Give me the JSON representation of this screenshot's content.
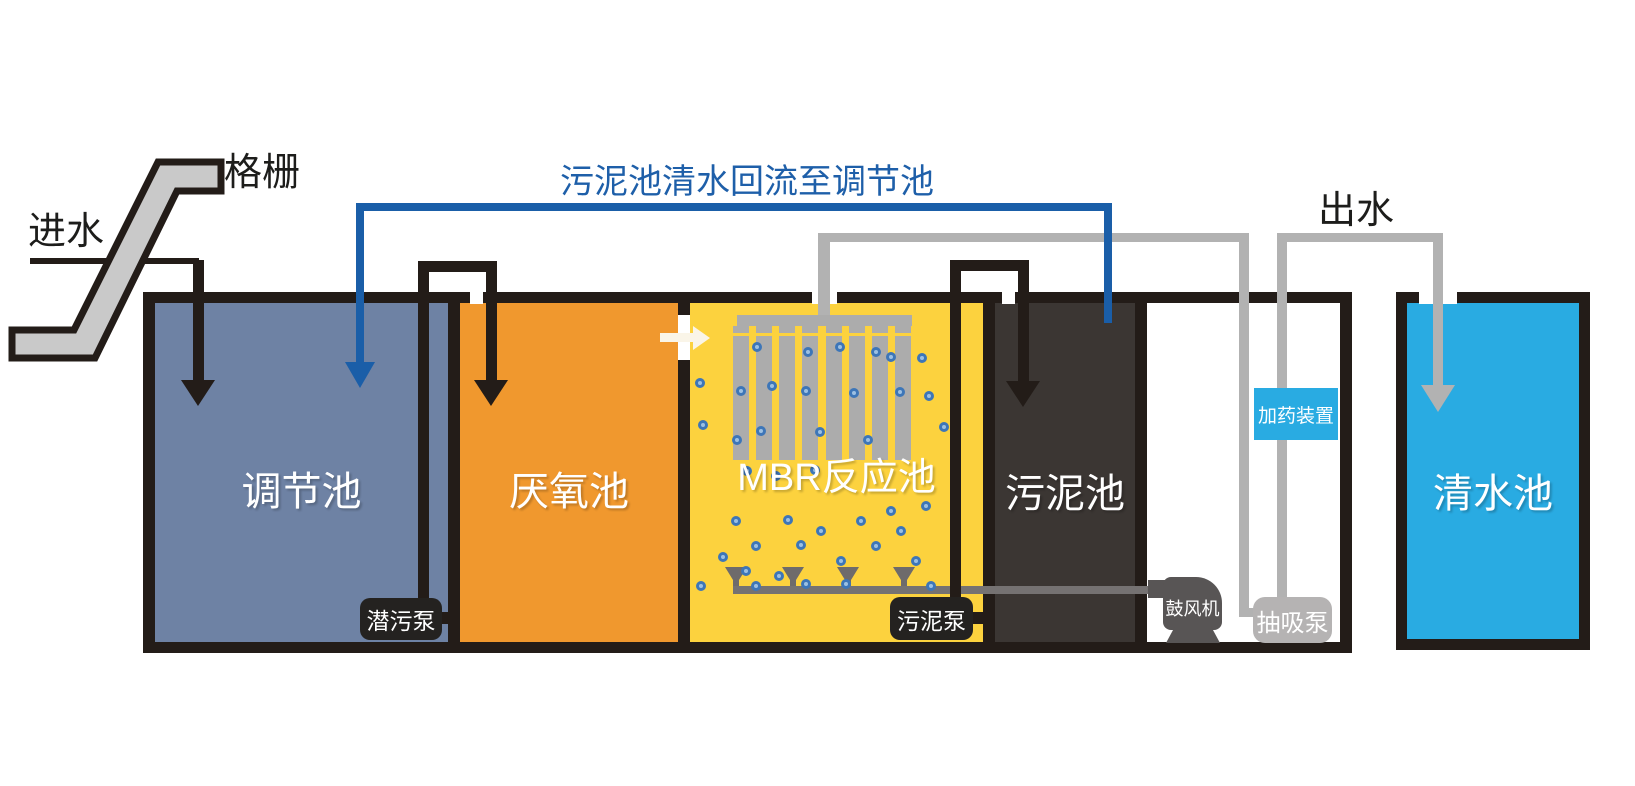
{
  "diagram": {
    "labels": {
      "inlet": "进水",
      "screen": "格栅",
      "outlet": "出水",
      "return_pipe": "污泥池清水回流至调节池"
    },
    "tanks": [
      {
        "name": "调节池",
        "color": "#6E82A4"
      },
      {
        "name": "厌氧池",
        "color": "#F0982E"
      },
      {
        "name": "MBR反应池",
        "color": "#FCD23E"
      },
      {
        "name": "污泥池",
        "color": "#3B3633"
      },
      {
        "name": "清水池",
        "color": "#29ABE2"
      }
    ],
    "equipment": {
      "submersible_pump": "潜污泵",
      "sludge_pump": "污泥泵",
      "blower": "鼓风机",
      "suction_pump": "抽吸泵",
      "dosing_device": "加药装置"
    },
    "colors": {
      "tank_border": "#231C18",
      "regulation_tank": "#6E82A4",
      "anaerobic_tank": "#F0982E",
      "mbr_tank": "#FCD23E",
      "sludge_tank": "#3B3633",
      "clean_water_tank": "#29ABE2",
      "dosing_box": "#29ABE2",
      "return_pipe": "#1A5EA8",
      "return_text": "#1E5FA9",
      "gray_pipe": "#B2B2B2",
      "aeration_pipe": "#757272",
      "bar_screen": "#C9C9C9",
      "bubble": "#3D76B8",
      "pump_box": "#242220",
      "suction_pump_box": "#B5B3B3",
      "blower_body": "#585555"
    }
  }
}
